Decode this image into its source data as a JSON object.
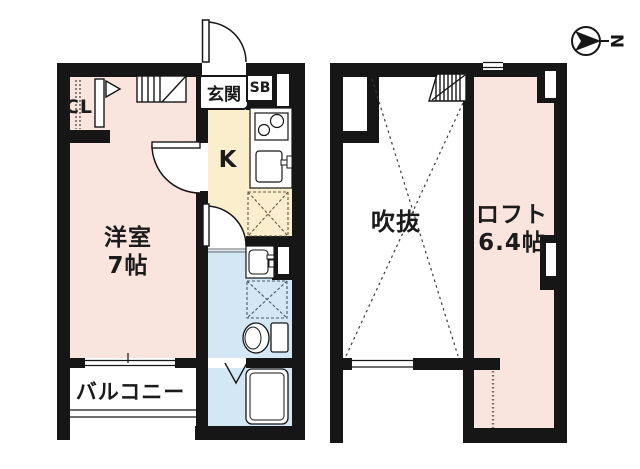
{
  "type": "apartment-floor-plan",
  "compass": {
    "north_label": "N"
  },
  "first_floor": {
    "rooms": {
      "entrance_label": "玄関",
      "shoe_box_label": "SB",
      "kitchen_label": "K",
      "closet_label": "CL",
      "western_room_label": "洋室",
      "western_room_size": "7帖",
      "balcony_label": "バルコニー"
    },
    "fixtures": [
      "staircase",
      "entrance-door",
      "gas-stove",
      "kitchen-sink",
      "refrigerator-space",
      "washbasin",
      "washing-machine-space",
      "toilet",
      "bathtub",
      "balcony-window",
      "room-doors"
    ]
  },
  "second_floor": {
    "rooms": {
      "void_label": "吹抜",
      "loft_label": "ロフト",
      "loft_size": "6.4帖"
    },
    "fixtures": [
      "staircase",
      "void-cross-mark",
      "void-window",
      "top-window",
      "right-windows",
      "loft-ladder-line"
    ]
  },
  "colors": {
    "wall": "#161616",
    "room_pink": "#fae5de",
    "kitchen_cream": "#fbeecd",
    "water_blue": "#d4e7f4",
    "background": "#ffffff"
  }
}
